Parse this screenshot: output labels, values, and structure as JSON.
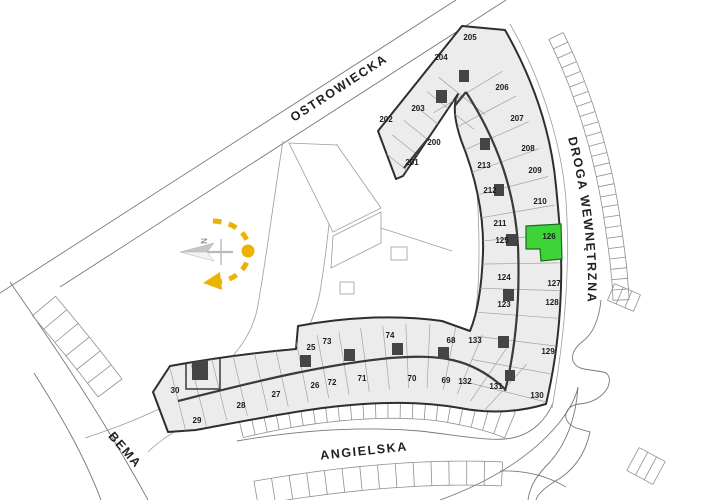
{
  "site_plan": {
    "streets": {
      "top": "OSTROWIECKA",
      "right": "DROGA WEWNĘTRZNA",
      "bottom": "ANGIELSKA",
      "left": "BEMA"
    },
    "compass": {
      "north_label": "N",
      "accent_color": "#EBB300"
    },
    "highlight": {
      "unit": "126",
      "color": "#3FD33A",
      "outline": "#1A6B1A",
      "label_color": "#0E4D0E"
    },
    "units": [
      {
        "num": "202",
        "x": 386,
        "y": 122
      },
      {
        "num": "203",
        "x": 418,
        "y": 111
      },
      {
        "num": "204",
        "x": 441,
        "y": 60
      },
      {
        "num": "205",
        "x": 470,
        "y": 40
      },
      {
        "num": "200",
        "x": 434,
        "y": 145
      },
      {
        "num": "201",
        "x": 412,
        "y": 165
      },
      {
        "num": "206",
        "x": 502,
        "y": 90
      },
      {
        "num": "207",
        "x": 517,
        "y": 121
      },
      {
        "num": "208",
        "x": 528,
        "y": 151
      },
      {
        "num": "209",
        "x": 535,
        "y": 173
      },
      {
        "num": "213",
        "x": 484,
        "y": 168
      },
      {
        "num": "212",
        "x": 490,
        "y": 193
      },
      {
        "num": "210",
        "x": 540,
        "y": 204
      },
      {
        "num": "211",
        "x": 500,
        "y": 226
      },
      {
        "num": "125",
        "x": 502,
        "y": 243
      },
      {
        "num": "124",
        "x": 504,
        "y": 280
      },
      {
        "num": "127",
        "x": 554,
        "y": 286
      },
      {
        "num": "123",
        "x": 504,
        "y": 307
      },
      {
        "num": "128",
        "x": 552,
        "y": 305
      },
      {
        "num": "133",
        "x": 475,
        "y": 343
      },
      {
        "num": "129",
        "x": 548,
        "y": 354
      },
      {
        "num": "132",
        "x": 465,
        "y": 384
      },
      {
        "num": "131",
        "x": 496,
        "y": 389
      },
      {
        "num": "130",
        "x": 537,
        "y": 398
      },
      {
        "num": "30",
        "x": 175,
        "y": 393
      },
      {
        "num": "29",
        "x": 197,
        "y": 423
      },
      {
        "num": "28",
        "x": 241,
        "y": 408
      },
      {
        "num": "27",
        "x": 276,
        "y": 397
      },
      {
        "num": "26",
        "x": 315,
        "y": 388
      },
      {
        "num": "25",
        "x": 311,
        "y": 350
      },
      {
        "num": "73",
        "x": 327,
        "y": 344
      },
      {
        "num": "72",
        "x": 332,
        "y": 385
      },
      {
        "num": "71",
        "x": 362,
        "y": 381
      },
      {
        "num": "74",
        "x": 390,
        "y": 338
      },
      {
        "num": "70",
        "x": 412,
        "y": 381
      },
      {
        "num": "69",
        "x": 446,
        "y": 383
      },
      {
        "num": "68",
        "x": 451,
        "y": 343
      }
    ]
  }
}
